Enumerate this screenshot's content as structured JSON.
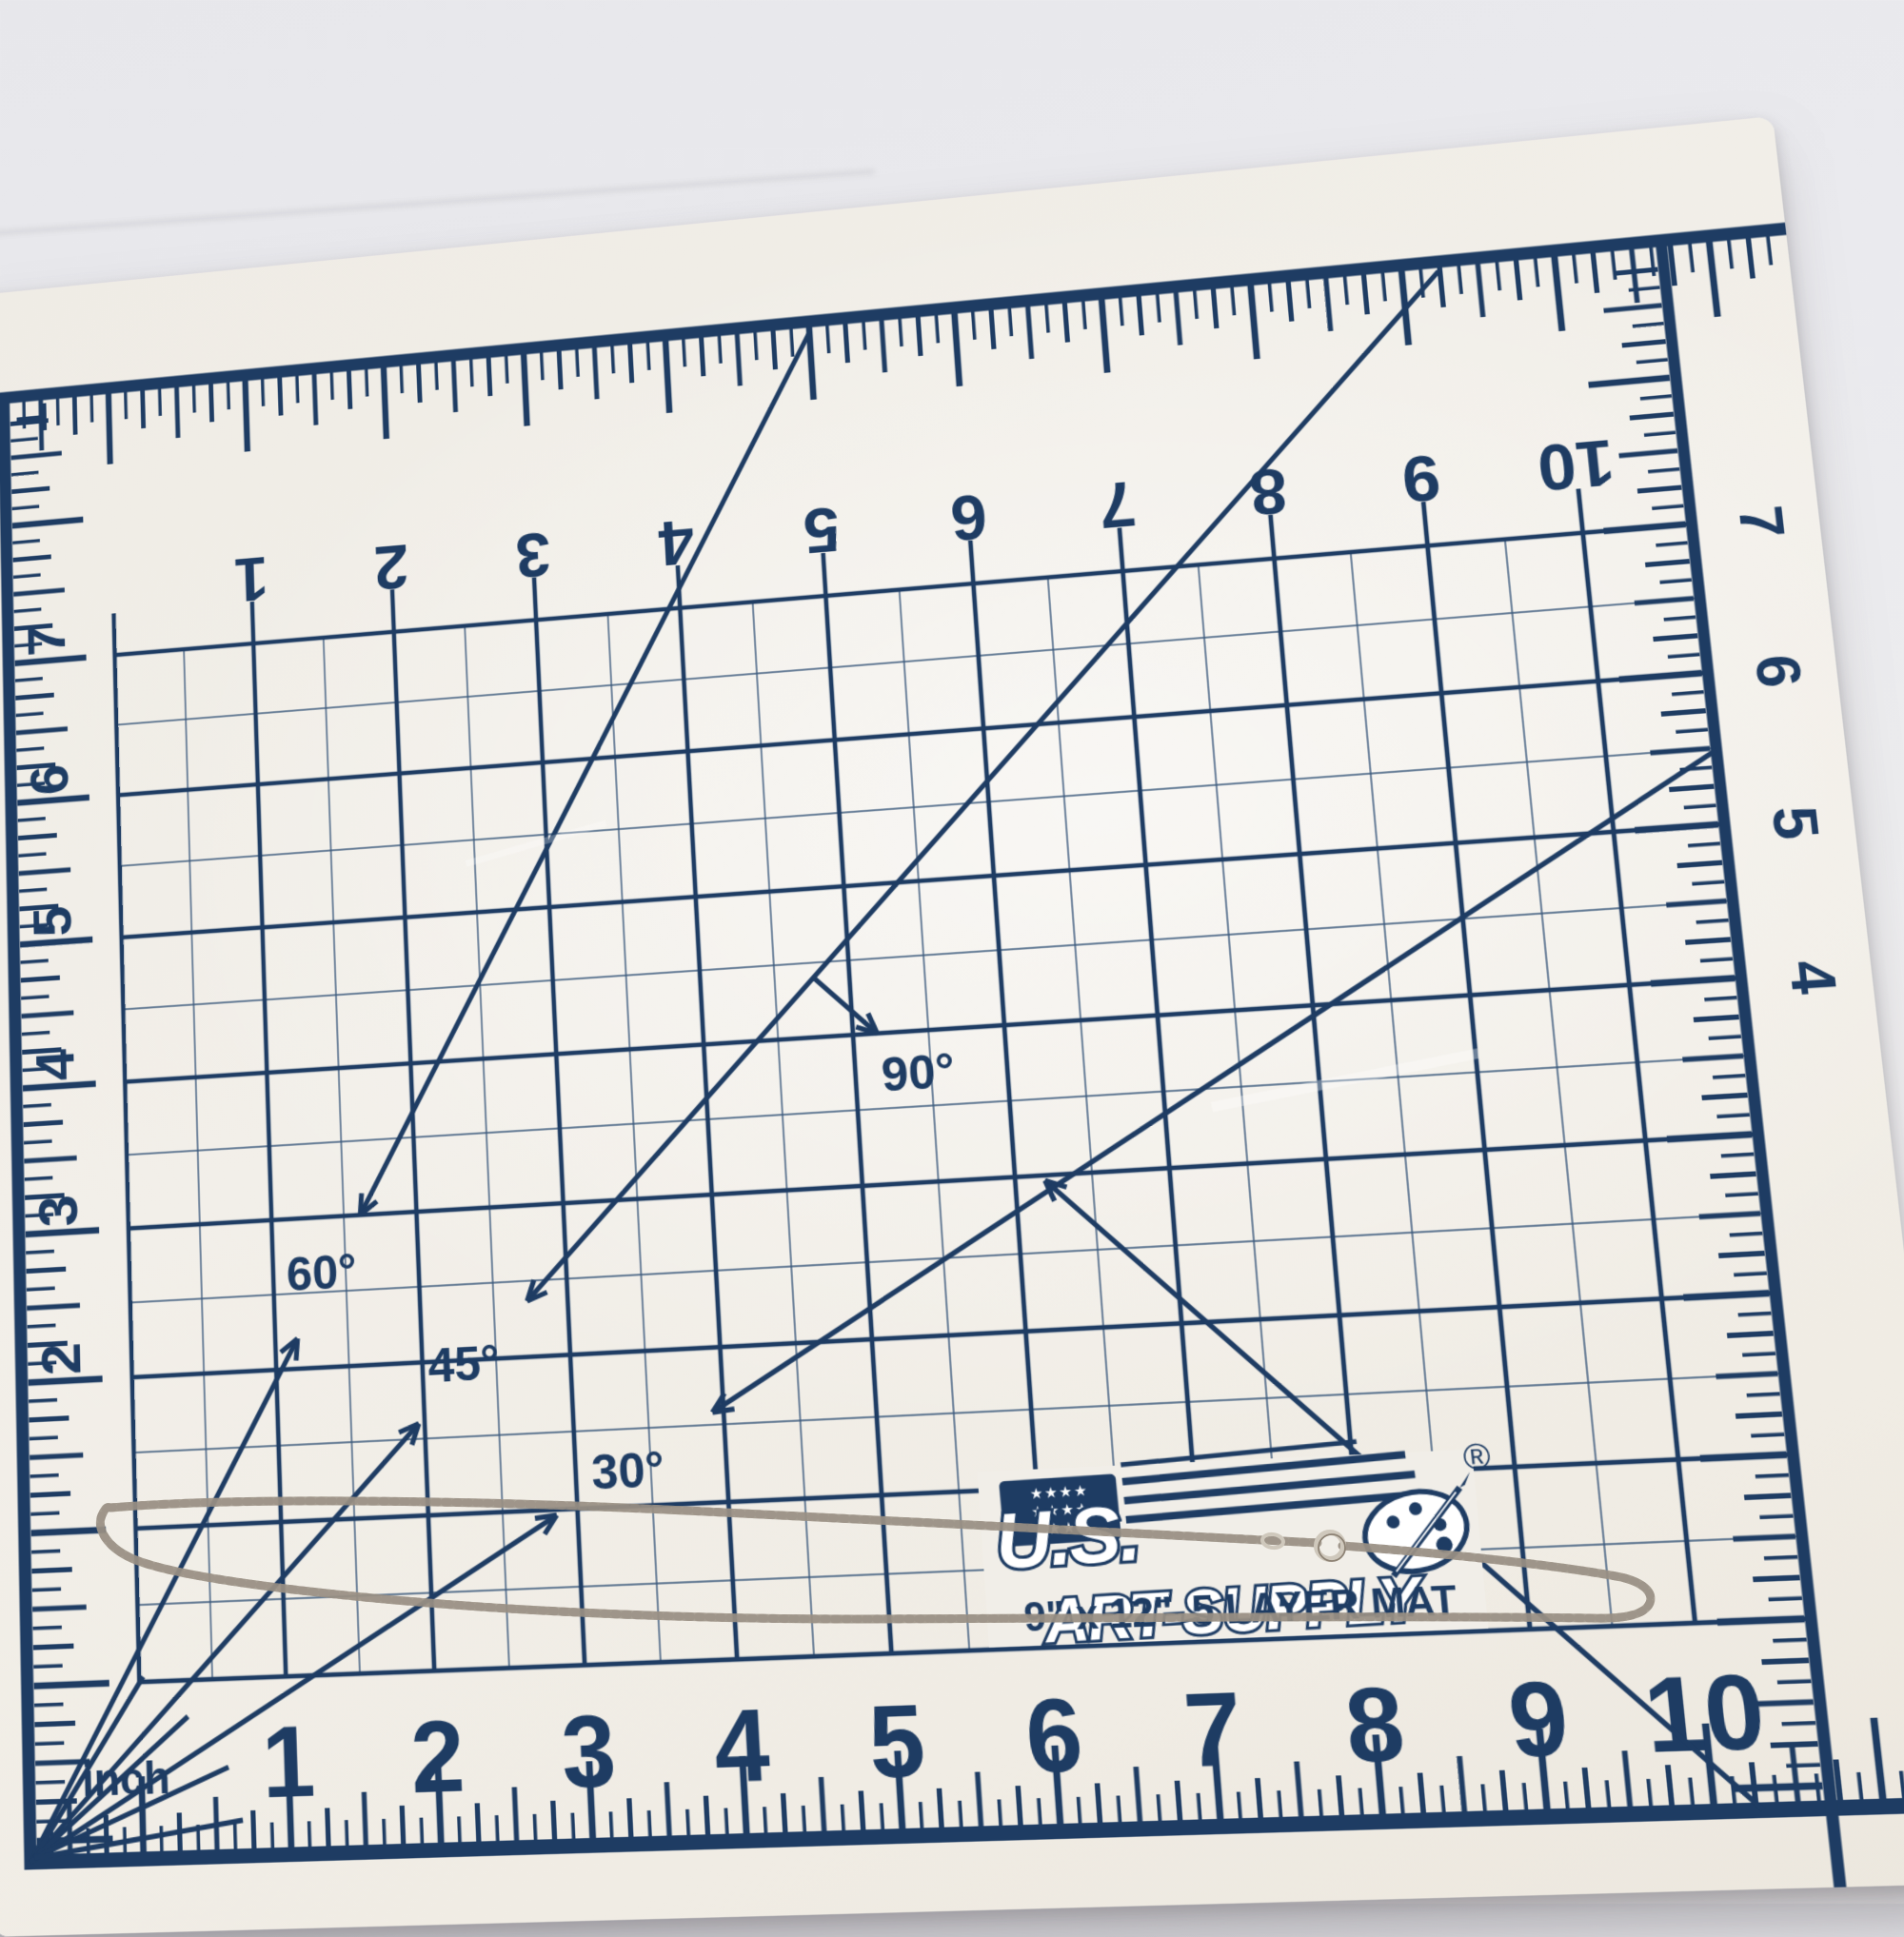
{
  "scene": {
    "backdrop_color": "#eaeaee",
    "mat_surface_color": "#f1eee8",
    "print_color": "#1e3c63",
    "chain_color": "#cfc4b0"
  },
  "mat": {
    "brand_top": "U.S.",
    "brand_bottom": "ART-SUPPLY",
    "registered_mark": "®",
    "flag_stars_row": "★ ★ ★ ★",
    "size_label": "9\" x 12\"",
    "layer_label": "5 LAYER MAT",
    "unit_label": "inch",
    "angle_labels": {
      "a30": "30°",
      "a45": "45°",
      "a60": "60°",
      "a90": "90°"
    },
    "top_numbers": [
      "1",
      "2",
      "3",
      "4",
      "5",
      "6",
      "7",
      "8",
      "9",
      "10"
    ],
    "bottom_numbers": [
      "1",
      "2",
      "3",
      "4",
      "5",
      "6",
      "7",
      "8",
      "9",
      "10"
    ],
    "left_numbers": [
      "7",
      "6",
      "5",
      "4",
      "3",
      "2"
    ],
    "right_numbers": [
      "7",
      "6",
      "5",
      "4"
    ]
  }
}
